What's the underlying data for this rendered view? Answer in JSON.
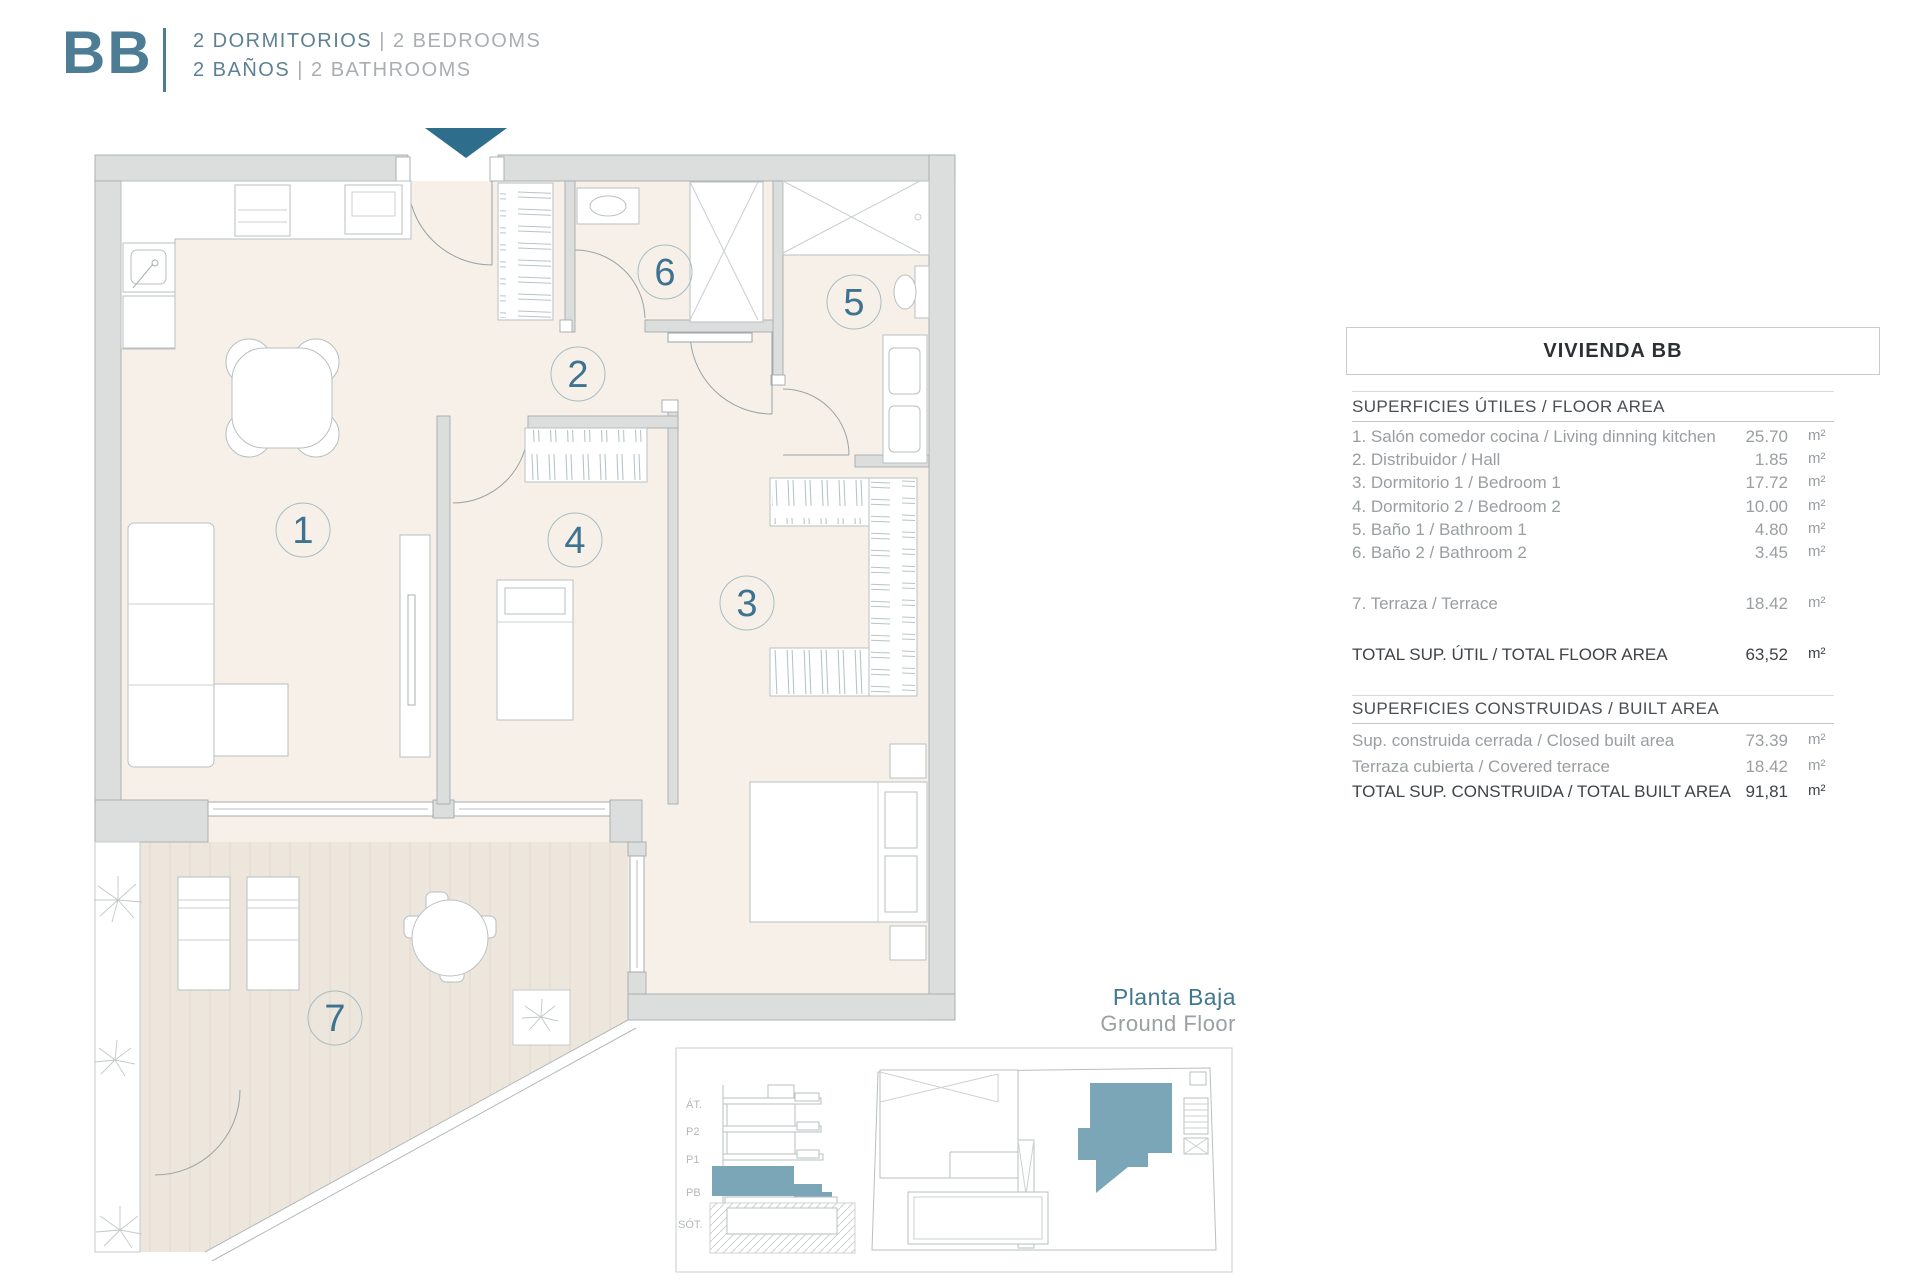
{
  "header": {
    "code": "BB",
    "line1_es": "2 DORMITORIOS",
    "line1_sep": "|",
    "line1_en": "2 BEDROOMS",
    "line2_es": "2 BAÑOS",
    "line2_sep": "|",
    "line2_en": "2 BATHROOMS"
  },
  "plan": {
    "rooms": [
      "1",
      "2",
      "3",
      "4",
      "5",
      "6",
      "7"
    ],
    "entrance_arrow": "down"
  },
  "table": {
    "title": "VIVIENDA BB",
    "section1_header": "SUPERFICIES ÚTILES / FLOOR AREA",
    "rows": [
      {
        "label": "1. Salón comedor cocina / Living dinning kitchen",
        "value": "25.70",
        "unit": "m²"
      },
      {
        "label": "2. Distribuidor / Hall",
        "value": "1.85",
        "unit": "m²"
      },
      {
        "label": "3. Dormitorio 1 / Bedroom 1",
        "value": "17.72",
        "unit": "m²"
      },
      {
        "label": "4. Dormitorio 2 / Bedroom 2",
        "value": "10.00",
        "unit": "m²"
      },
      {
        "label": "5. Baño 1 / Bathroom 1",
        "value": "4.80",
        "unit": "m²"
      },
      {
        "label": "6. Baño 2 / Bathroom 2",
        "value": "3.45",
        "unit": "m²"
      },
      {
        "label": "7. Terraza / Terrace",
        "value": "18.42",
        "unit": "m²"
      }
    ],
    "total_util": {
      "label": "TOTAL SUP. ÚTIL / TOTAL FLOOR AREA",
      "value": "63,52",
      "unit": "m²"
    },
    "section2_header": "SUPERFICIES CONSTRUIDAS / BUILT AREA",
    "built_rows": [
      {
        "label": "Sup. construida cerrada / Closed built area",
        "value": "73.39",
        "unit": "m²"
      },
      {
        "label": "Terraza cubierta / Covered terrace",
        "value": "18.42",
        "unit": "m²"
      }
    ],
    "total_built": {
      "label": "TOTAL SUP. CONSTRUIDA /  TOTAL BUILT AREA",
      "value": "91,81",
      "unit": "m²"
    }
  },
  "floor_label": {
    "es": "Planta Baja",
    "en": "Ground Floor"
  },
  "mini": {
    "levels": [
      "ÁT.",
      "P2",
      "P1",
      "PB",
      "SÓT."
    ]
  },
  "colors": {
    "teal": "#2e6e8c",
    "teal_light": "#7ba6b7",
    "wall": "#dcdedd",
    "floor": "#f6f0e9",
    "terrace": "#ede6dd",
    "accent_text": "#3d7390"
  }
}
